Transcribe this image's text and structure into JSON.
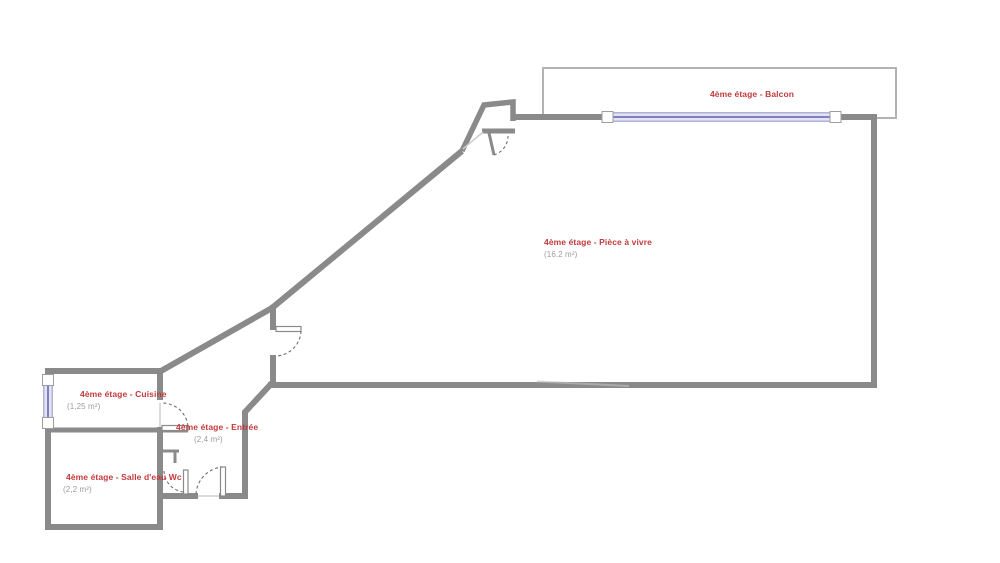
{
  "plan": {
    "floor_label": "4ème étage",
    "rooms": {
      "balcon": {
        "label": "4ème étage - Balcon"
      },
      "piece_a_vivre": {
        "label": "4ème étage - Pièce à vivre",
        "area": "(16.2 m²)"
      },
      "cuisine": {
        "label": "4ème étage - Cuisine",
        "area": "(1,25 m²)"
      },
      "entree": {
        "label": "4ème étage - Entrée",
        "area": "(2,4 m²)"
      },
      "salle_deau": {
        "label": "4ème étage - Salle d'eau Wc",
        "area": "(2,2 m²)"
      }
    },
    "colors": {
      "wall": "#8a8a8a",
      "balcony_outline": "#b3b3b3",
      "window_fill": "#e3e3f3",
      "window_frame": "#7272ba",
      "room_label": "#c23a3c",
      "area_text": "#9c9c9c"
    },
    "elements": {
      "windows": [
        "balcony-window",
        "kitchen-window"
      ],
      "doors": [
        "living-room-door",
        "closet-door",
        "kitchen-door",
        "bathroom-door",
        "entrance-door"
      ]
    }
  }
}
